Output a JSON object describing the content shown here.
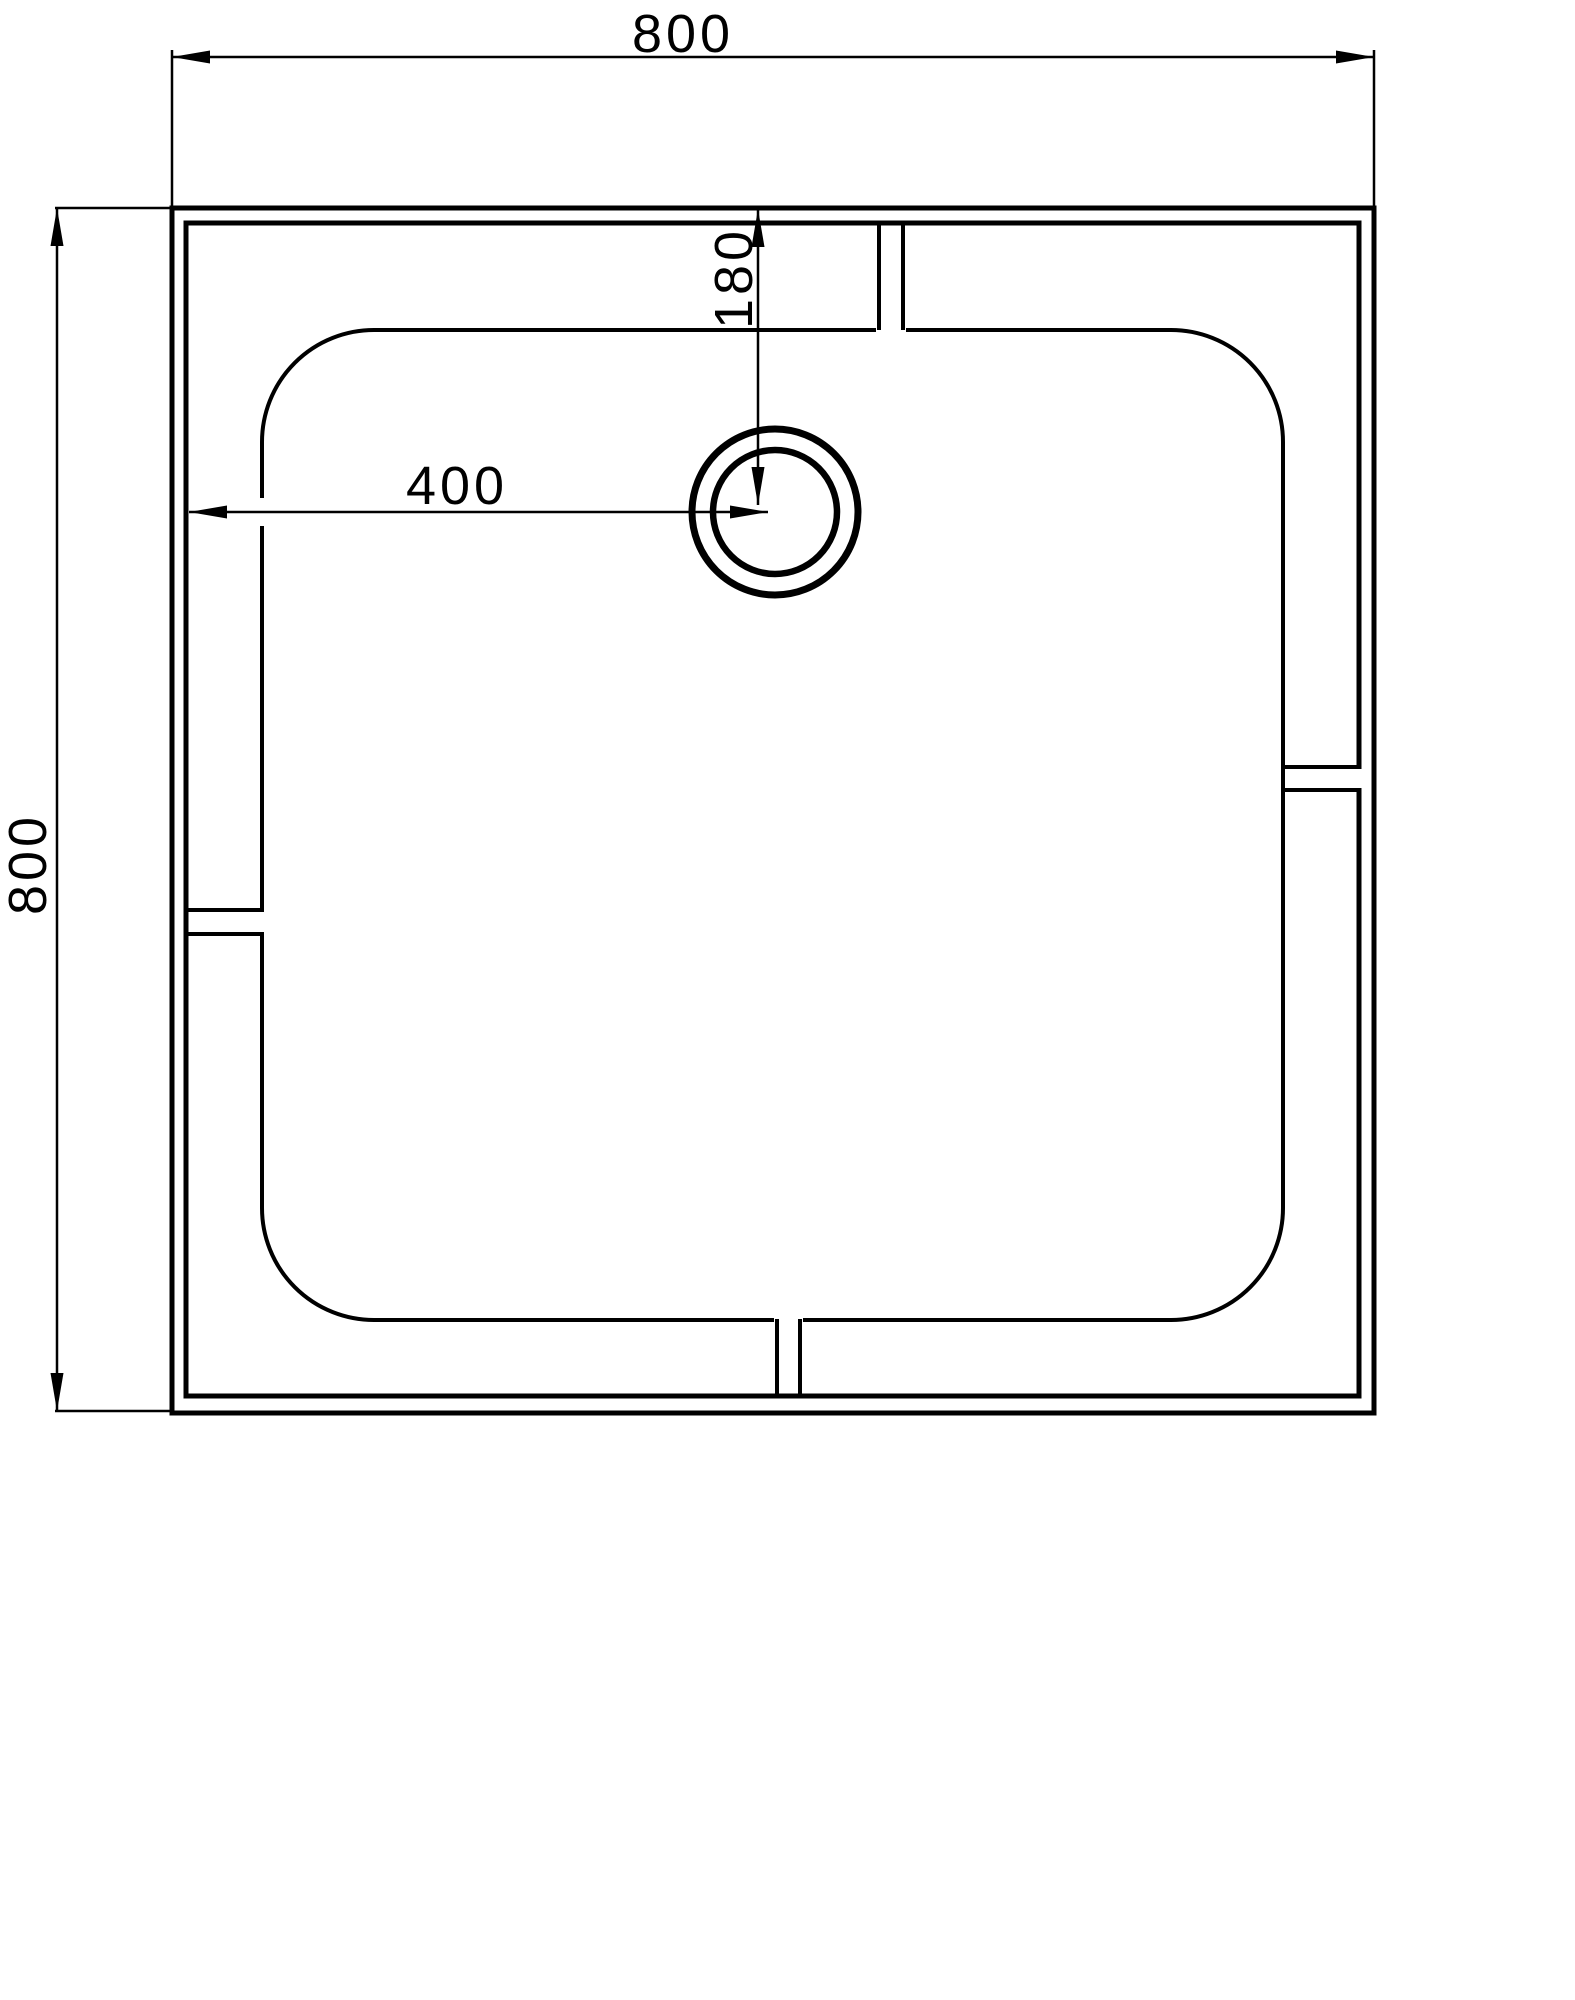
{
  "colors": {
    "line": "#000000",
    "background": "#ffffff"
  },
  "dimensions": {
    "overall_width": {
      "label": "800"
    },
    "overall_height": {
      "label": "800"
    },
    "drain_from_left": {
      "label": "400"
    },
    "drain_from_top": {
      "label": "180"
    }
  }
}
